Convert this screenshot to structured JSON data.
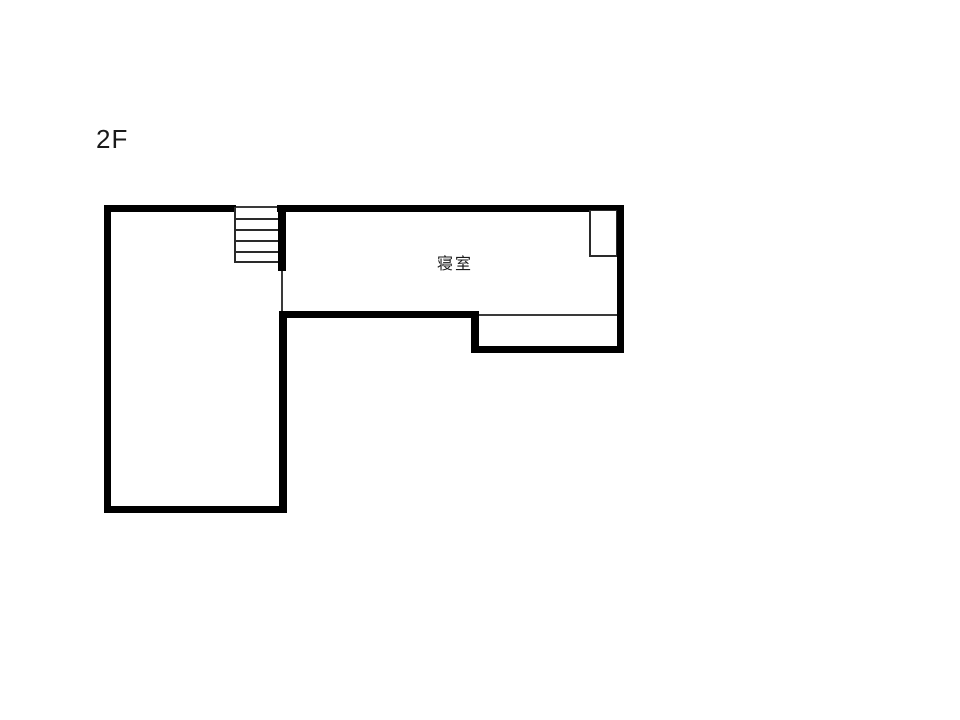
{
  "floor_label": "2F",
  "rooms": [
    {
      "name": "寝室"
    }
  ],
  "stairs": {
    "treads": 5
  },
  "colors": {
    "wall": "#000000",
    "thin_line": "#3a3a3a",
    "background": "#ffffff"
  }
}
